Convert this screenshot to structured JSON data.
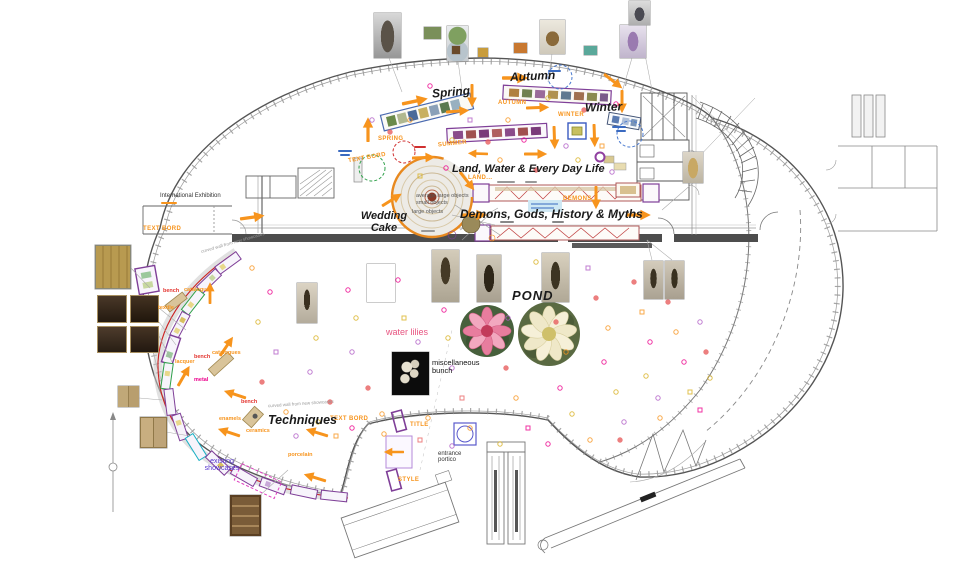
{
  "headings": {
    "international_exhibition": "International Exhibition",
    "spring": "Spring",
    "autumn": "Autumn",
    "winter": "Winter",
    "land_water": "Land, Water & Every Day Life",
    "demons": "Demons, Gods, History & Myths",
    "wedding_cake": "Wedding Cake",
    "pond": "POND",
    "techniques": "Techniques"
  },
  "annotations": {
    "water_lilies": "water lilies",
    "misc_bunch": "miscellaneous bunch",
    "entrance_portico": "entrance portico",
    "existing_showcases": "existing showcases",
    "objects_avg": "average large objects",
    "objects_small": "small objects",
    "objects_large": "large objects",
    "curved_wall": "curved wall from new showcases"
  },
  "tags": {
    "spring": "SPRING",
    "summer": "SUMMER",
    "autumn": "AUTUMN",
    "winter": "WINTER",
    "land": "LAND...",
    "demons": "DEMONS",
    "text_bord": "TEXT BORD",
    "title": "TITLE",
    "style": "STYLE"
  },
  "materials": {
    "bench": "bench",
    "catalogues": "catalogues",
    "textile": "textile",
    "lacquer": "lacquer",
    "metal": "metal",
    "enamels": "enamels",
    "ceramics": "ceramics",
    "porcelain": "porcelain"
  },
  "colors": {
    "accent_orange": "#F7941D",
    "magenta": "#EC008C",
    "red": "#E3342F",
    "blue": "#3B5BD6",
    "purple": "#7F3F98",
    "green": "#2FA04A",
    "route_red": "#CC2222",
    "wall_dark": "#4D4D4D"
  },
  "images": [
    {
      "name": "stone-figure-photo",
      "desc": "grey stone figure"
    },
    {
      "name": "flower-vase-photo",
      "desc": "vase with flowers"
    },
    {
      "name": "duck-photo",
      "desc": "bronze duck"
    },
    {
      "name": "ornate-vase-photo",
      "desc": "ornate vase"
    },
    {
      "name": "top-urn-photo",
      "desc": "small urn"
    },
    {
      "name": "censer-photo",
      "desc": "tan censer"
    },
    {
      "name": "gold-panel-photo",
      "desc": "gold panel"
    },
    {
      "name": "dark-panels-photo",
      "desc": "four dark panels"
    },
    {
      "name": "tan-door-photos",
      "desc": "tan door panels"
    },
    {
      "name": "cabinet-photo",
      "desc": "wooden cabinet"
    },
    {
      "name": "bronze-statue-photos",
      "desc": "bronze statues"
    },
    {
      "name": "misc-bunch-photo",
      "desc": "white coral bunch on black"
    },
    {
      "name": "pink-water-lily",
      "desc": "pink water lily"
    },
    {
      "name": "white-water-lily",
      "desc": "white water lily"
    }
  ]
}
